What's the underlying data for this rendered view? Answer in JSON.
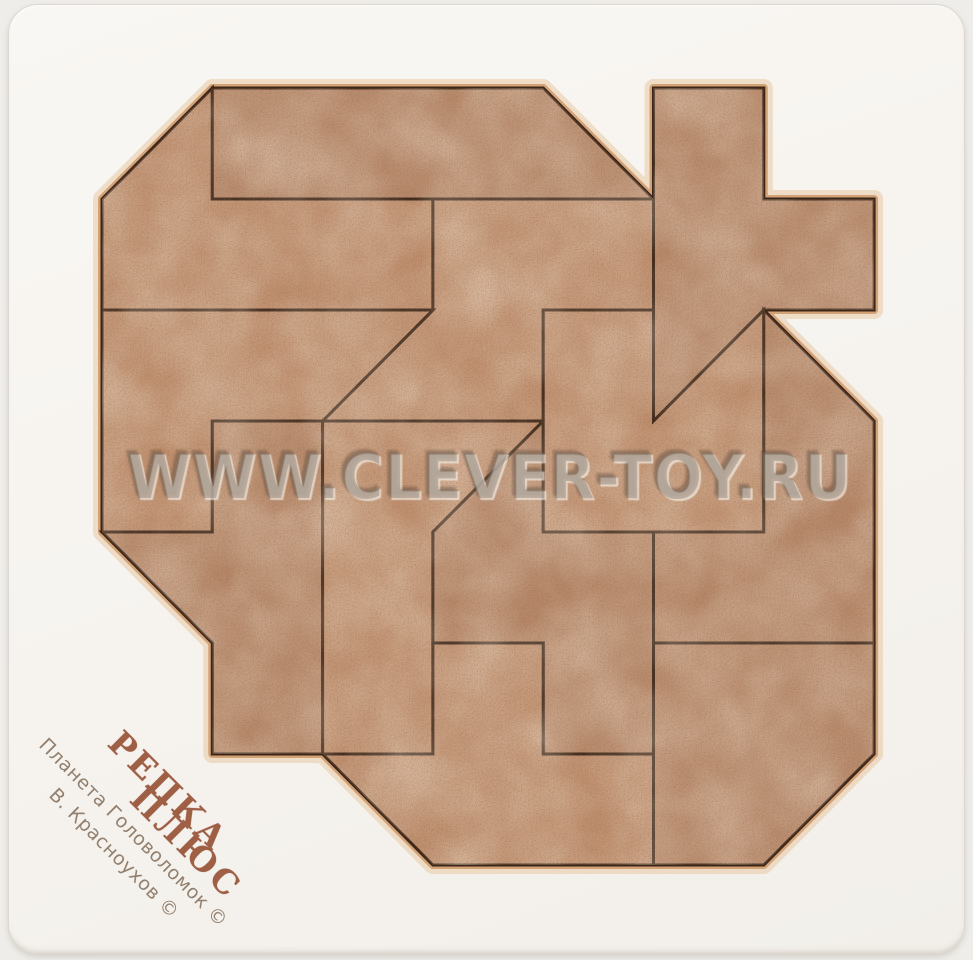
{
  "scene": {
    "background_color": "#efede9",
    "tray_color": "#f6f3ef"
  },
  "watermark": {
    "text": "WWW.CLEVER-TOY.RU",
    "color": "rgba(133,122,110,0.42)"
  },
  "branding": {
    "title_line1": "РЕПКА",
    "title_line2": "ПЛЮС",
    "credit_line1": "Планета Головоломок ©",
    "credit_line2": "В. Красноухов ©",
    "title_color": "#9e5f45",
    "credit_color": "#93806e"
  },
  "puzzle": {
    "material": "mdf-wood",
    "wood_color": "#c09070",
    "wood_color_alt": "#b8896b",
    "cut_line_color": "#3c2517",
    "rim_color": "#d4a277",
    "rim_glow_color": "#e8c9a4",
    "grid": {
      "origin_x": 102,
      "origin_y": 88,
      "unit_x": 110.3,
      "unit_y": 111.0,
      "cols": 7,
      "rows": 7
    },
    "outline": [
      [
        1,
        0
      ],
      [
        4,
        0
      ],
      [
        5,
        1
      ],
      [
        5,
        0
      ],
      [
        6,
        0
      ],
      [
        6,
        1
      ],
      [
        7,
        1
      ],
      [
        7,
        2
      ],
      [
        6,
        2
      ],
      [
        7,
        3
      ],
      [
        7,
        6
      ],
      [
        6,
        7
      ],
      [
        3,
        7
      ],
      [
        2,
        6
      ],
      [
        1,
        6
      ],
      [
        1,
        5
      ],
      [
        0,
        4
      ],
      [
        0,
        1
      ]
    ],
    "pieces": [
      {
        "name": "top-left-L",
        "points": [
          [
            0,
            1
          ],
          [
            1,
            0
          ],
          [
            1,
            1
          ],
          [
            3,
            1
          ],
          [
            3,
            2
          ],
          [
            0,
            2
          ]
        ]
      },
      {
        "name": "top-strip",
        "points": [
          [
            1,
            0
          ],
          [
            4,
            0
          ],
          [
            5,
            1
          ],
          [
            1,
            1
          ]
        ]
      },
      {
        "name": "upper-middle-step",
        "points": [
          [
            3,
            1
          ],
          [
            5,
            1
          ],
          [
            5,
            2
          ],
          [
            4,
            2
          ],
          [
            4,
            3
          ],
          [
            2,
            3
          ],
          [
            3,
            2
          ]
        ]
      },
      {
        "name": "cross",
        "points": [
          [
            5,
            0
          ],
          [
            6,
            0
          ],
          [
            6,
            1
          ],
          [
            7,
            1
          ],
          [
            7,
            2
          ],
          [
            6,
            2
          ],
          [
            5,
            3
          ]
        ]
      },
      {
        "name": "left-block",
        "points": [
          [
            0,
            2
          ],
          [
            3,
            2
          ],
          [
            2,
            3
          ],
          [
            1,
            3
          ],
          [
            1,
            4
          ],
          [
            0,
            4
          ]
        ]
      },
      {
        "name": "left-column",
        "points": [
          [
            1,
            3
          ],
          [
            2,
            3
          ],
          [
            2,
            6
          ],
          [
            1,
            6
          ],
          [
            1,
            5
          ],
          [
            0,
            4
          ],
          [
            1,
            4
          ]
        ]
      },
      {
        "name": "middle-column",
        "points": [
          [
            2,
            3
          ],
          [
            4,
            3
          ],
          [
            3,
            4
          ],
          [
            3,
            6
          ],
          [
            2,
            6
          ]
        ]
      },
      {
        "name": "center-s",
        "points": [
          [
            4,
            3
          ],
          [
            4,
            4
          ],
          [
            5,
            4
          ],
          [
            5,
            6
          ],
          [
            4,
            6
          ],
          [
            4,
            5
          ],
          [
            3,
            5
          ],
          [
            3,
            4
          ]
        ]
      },
      {
        "name": "notched-square",
        "points": [
          [
            4,
            2
          ],
          [
            5,
            2
          ],
          [
            5,
            3
          ],
          [
            6,
            2
          ],
          [
            6,
            4
          ],
          [
            4,
            4
          ]
        ]
      },
      {
        "name": "right-block",
        "points": [
          [
            5,
            4
          ],
          [
            6,
            4
          ],
          [
            6,
            2
          ],
          [
            7,
            3
          ],
          [
            7,
            5
          ],
          [
            5,
            5
          ]
        ]
      },
      {
        "name": "bottom-block",
        "points": [
          [
            3,
            5
          ],
          [
            4,
            5
          ],
          [
            4,
            6
          ],
          [
            5,
            6
          ],
          [
            5,
            7
          ],
          [
            3,
            7
          ],
          [
            2,
            6
          ],
          [
            3,
            6
          ]
        ]
      },
      {
        "name": "bottom-right-block",
        "points": [
          [
            5,
            5
          ],
          [
            7,
            5
          ],
          [
            7,
            6
          ],
          [
            6,
            7
          ],
          [
            5,
            7
          ]
        ]
      }
    ]
  }
}
